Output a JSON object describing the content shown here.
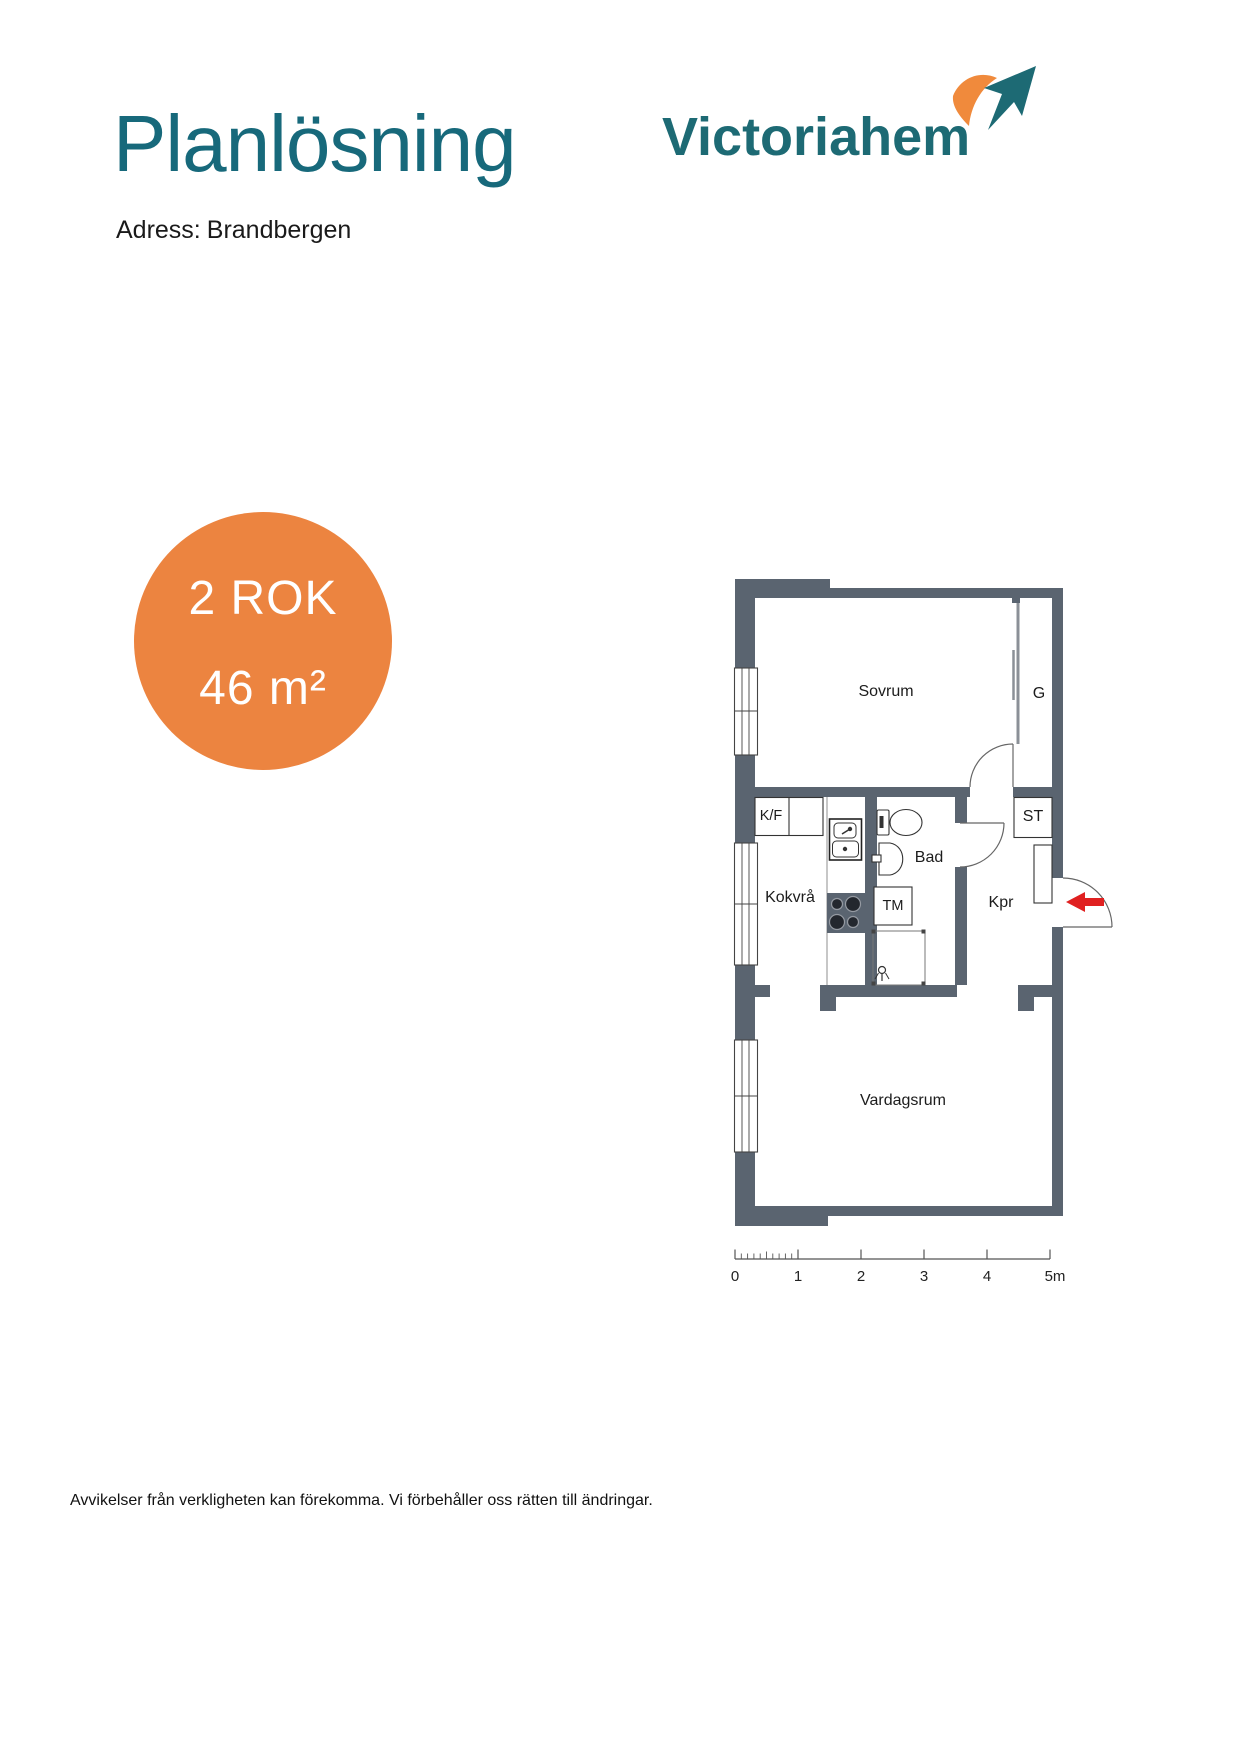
{
  "header": {
    "title": "Planlösning",
    "address_label": "Adress:",
    "address_value": "Brandbergen"
  },
  "logo": {
    "text": "Victoriahem",
    "icon": "bird-checkmark-icon"
  },
  "badge": {
    "rooms": "2 ROK",
    "area": "46 m²"
  },
  "plan": {
    "rooms": [
      {
        "id": "sovrum",
        "label": "Sovrum"
      },
      {
        "id": "g",
        "label": "G"
      },
      {
        "id": "kf",
        "label": "K/F"
      },
      {
        "id": "bad",
        "label": "Bad"
      },
      {
        "id": "kokvra",
        "label": "Kokvrå"
      },
      {
        "id": "tm",
        "label": "TM"
      },
      {
        "id": "kpr",
        "label": "Kpr"
      },
      {
        "id": "st",
        "label": "ST"
      },
      {
        "id": "vardagsrum",
        "label": "Vardagsrum"
      }
    ]
  },
  "scale_bar": {
    "labels": [
      "0",
      "1",
      "2",
      "3",
      "4",
      "5m"
    ]
  },
  "footer": {
    "disclaimer": "Avvikelser från verkligheten kan förekomma. Vi förbehåller oss rätten till ändringar."
  },
  "colors": {
    "title_teal": "#17697b",
    "logo_teal": "#1d6a74",
    "logo_orange": "#f08a3c",
    "badge_orange": "#ec8440",
    "wall": "#5a6470",
    "arrow_red": "#e02020"
  }
}
